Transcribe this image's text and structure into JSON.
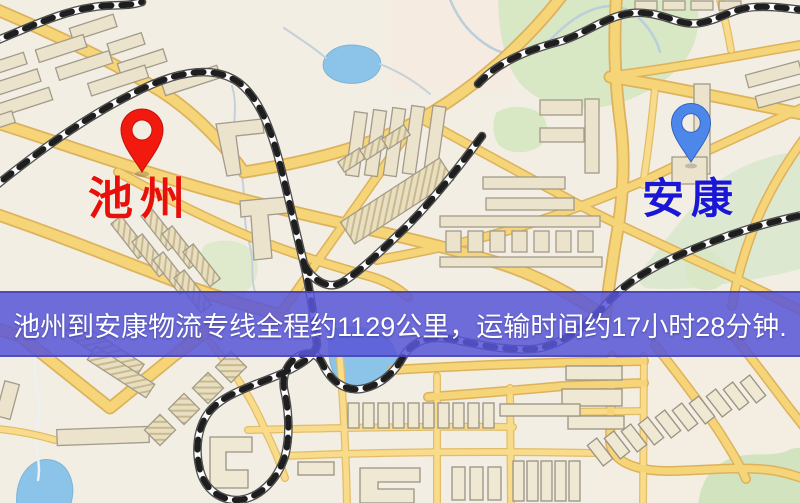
{
  "map": {
    "origin_marker": {
      "label": "池州",
      "icon": "red-map-pin-icon",
      "pin_color": "#f2190e",
      "label_color": "#e8100a"
    },
    "destination_marker": {
      "label": "安康",
      "icon": "blue-map-pin-icon",
      "pin_color": "#4d87ea",
      "label_color": "#1a16d6"
    }
  },
  "banner": {
    "text": "池州到安康物流专线全程约1129公里，运输时间约17小时28分钟.",
    "background_color": "#5856d7",
    "text_color": "#ffffff",
    "route": {
      "origin": "池州",
      "destination": "安康",
      "distance_km": "1129",
      "duration": "17小时28分钟"
    }
  },
  "map_style": {
    "background_color": "#f2eee3",
    "road_color": "#f6d478",
    "road_casing_color": "#ddb25c",
    "park_color": "#d8e7c4",
    "water_color": "#8bc4e8",
    "railway_color": "#1e1e1e",
    "building_color": "#ebe3cb"
  }
}
